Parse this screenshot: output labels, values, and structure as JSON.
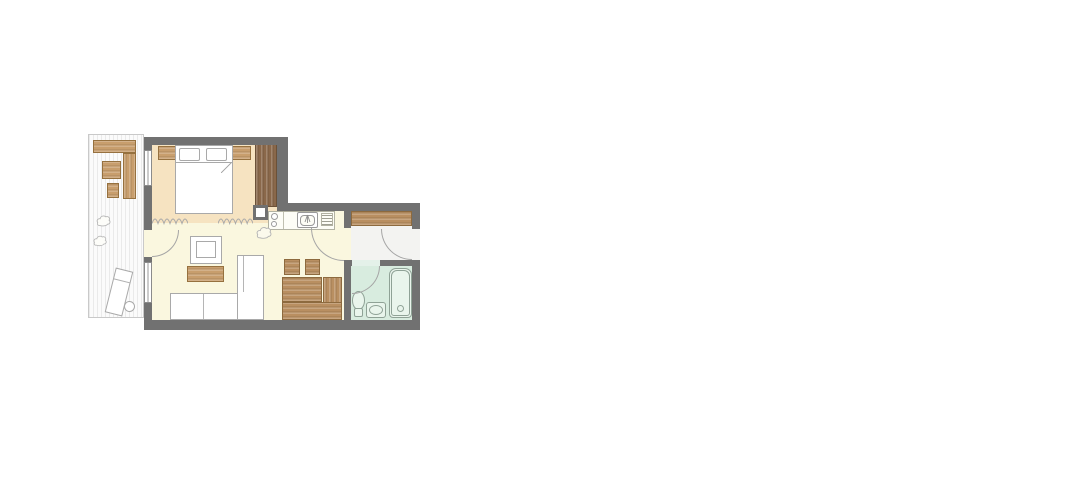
{
  "colors": {
    "background": "#ffffff",
    "wall": "#717171",
    "bedroom_floor": "#f6e3c1",
    "living_floor": "#faf7df",
    "hall_floor": "#f3f3f1",
    "bathroom_floor": "#d8ecdf",
    "balcony_deck": "#fbfbfb",
    "deck_stripe": "#eaeaea",
    "wood_light": "#c89e6d",
    "wood_medium": "#b98f61",
    "wood_dark": "#8a684a",
    "counter_fill": "#fdfdf6",
    "fixture_fill": "#e9f5ec",
    "fixture_outline": "#8fa296",
    "outline_gray": "#a9a9a9"
  },
  "floorplan": {
    "type": "apartment-floor-plan",
    "areas": [
      {
        "id": "balcony",
        "items": [
          "wall-bench",
          "side-unit",
          "table",
          "stool",
          "plant",
          "plant",
          "sun-lounger",
          "round-side-table"
        ]
      },
      {
        "id": "bedroom",
        "items": [
          "nightstand",
          "double-bed",
          "pillow",
          "pillow",
          "duvet",
          "nightstand",
          "wardrobe"
        ],
        "divider": "curtain-zigzag"
      },
      {
        "id": "living-room",
        "items": [
          "armchair",
          "coffee-table",
          "corner-sofa-with-chaise",
          "plant"
        ]
      },
      {
        "id": "kitchen",
        "items": [
          "counter",
          "cooktop-two-burners",
          "sink-with-tap",
          "dish-drainer",
          "service-column"
        ]
      },
      {
        "id": "dining",
        "items": [
          "chair",
          "chair",
          "table",
          "corner-bench"
        ]
      },
      {
        "id": "hall",
        "items": [
          "wardrobe"
        ]
      },
      {
        "id": "bathroom",
        "items": [
          "toilet",
          "washbasin",
          "bathtub"
        ]
      }
    ],
    "openings": [
      "bedroom-window",
      "living-room-window",
      "balcony-door",
      "hall-door",
      "entrance-door",
      "bathroom-door"
    ]
  }
}
